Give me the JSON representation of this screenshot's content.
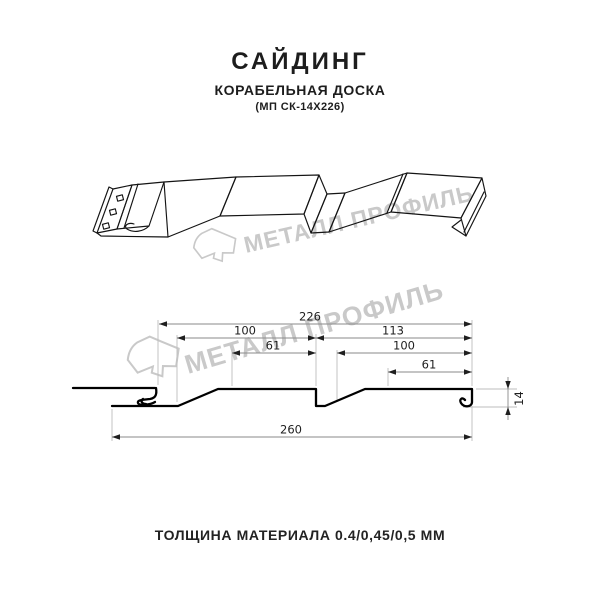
{
  "title": {
    "main": "САЙДИНГ",
    "subtitle": "КОРАБЕЛЬНАЯ ДОСКА",
    "model": "(МП СК-14Х226)"
  },
  "watermark": {
    "text": "МЕТАЛЛ ПРОФИЛЬ",
    "color": "#c9c9c9"
  },
  "dims": {
    "d226": "226",
    "d100_left": "100",
    "d113": "113",
    "d61_left": "61",
    "d100_right": "100",
    "d61_right": "61",
    "d14": "14",
    "d260": "260"
  },
  "footer": {
    "text": "ТОЛЩИНА МАТЕРИАЛА 0.4/0,45/0,5 ММ"
  }
}
